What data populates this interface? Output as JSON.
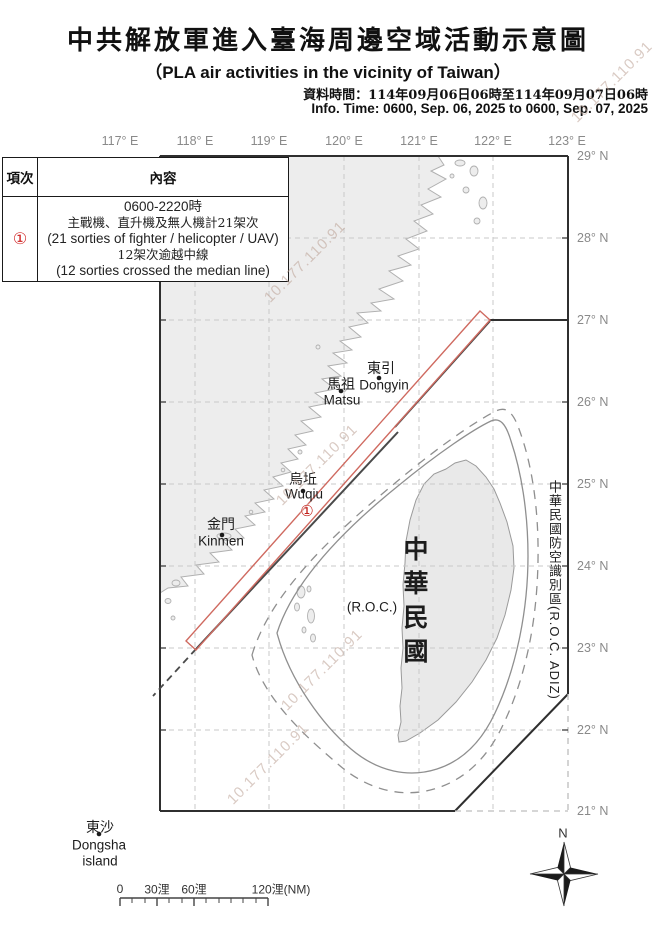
{
  "header": {
    "title": "中共解放軍進入臺海周邊空域活動示意圖",
    "subtitle": "（PLA air activities in the vicinity of Taiwan）",
    "info_zh": "資料時間：114年09月06日06時至114年09月07日06時",
    "info_en": "Info. Time: 0600, Sep. 06, 2025 to 0600, Sep. 07, 2025"
  },
  "table": {
    "header": {
      "item": "項次",
      "content": "內容"
    },
    "row": {
      "num": "①",
      "lines": [
        "0600-2220時",
        "主戰機、直升機及無人機計21架次",
        "(21 sorties of fighter / helicopter / UAV)",
        "12架次逾越中線",
        "(12 sorties crossed the median line)"
      ]
    }
  },
  "axes": {
    "lon": [
      "117° E",
      "118° E",
      "119° E",
      "120° E",
      "121° E",
      "122° E",
      "123° E"
    ],
    "lat": [
      "29° N",
      "28° N",
      "27° N",
      "26° N",
      "25° N",
      "24° N",
      "23° N",
      "22° N",
      "21° N"
    ]
  },
  "map": {
    "labels": {
      "dongyin_zh": "東引",
      "dongyin_en": "Dongyin",
      "matsu_zh": "馬祖",
      "matsu_en": "Matsu",
      "wuqiu_zh": "烏坵",
      "wuqiu_en": "Wuqiu",
      "kinmen_zh": "金門",
      "kinmen_en": "Kinmen",
      "dongsha_zh": "東沙",
      "dongsha_en1": "Dongsha",
      "dongsha_en2": "island",
      "roc_vertical": "中華民國",
      "roc_paren": "(R.O.C.)",
      "adiz_vertical": "中華民國防空識別區(R.O.C. ADIZ)"
    },
    "marker_1": "①",
    "compass_n": "N"
  },
  "scalebar": {
    "labels": [
      "0",
      "30浬",
      "60浬",
      "120浬(NM)"
    ]
  },
  "watermark": {
    "text": "10.177.110.91"
  },
  "colors": {
    "activity_red": "#cf6a60",
    "marker_red": "#c2201a",
    "frame_dark": "#2f2f2f",
    "grid_gray": "#c9c9c9",
    "land_fill": "#ededed",
    "coast_stroke": "#b0b0b0",
    "contour_gray": "#8f8f8f",
    "median_dark": "#4a4a4a",
    "axis_label_gray": "#8a8a8a",
    "watermark_pink": "#c9b4aa"
  }
}
